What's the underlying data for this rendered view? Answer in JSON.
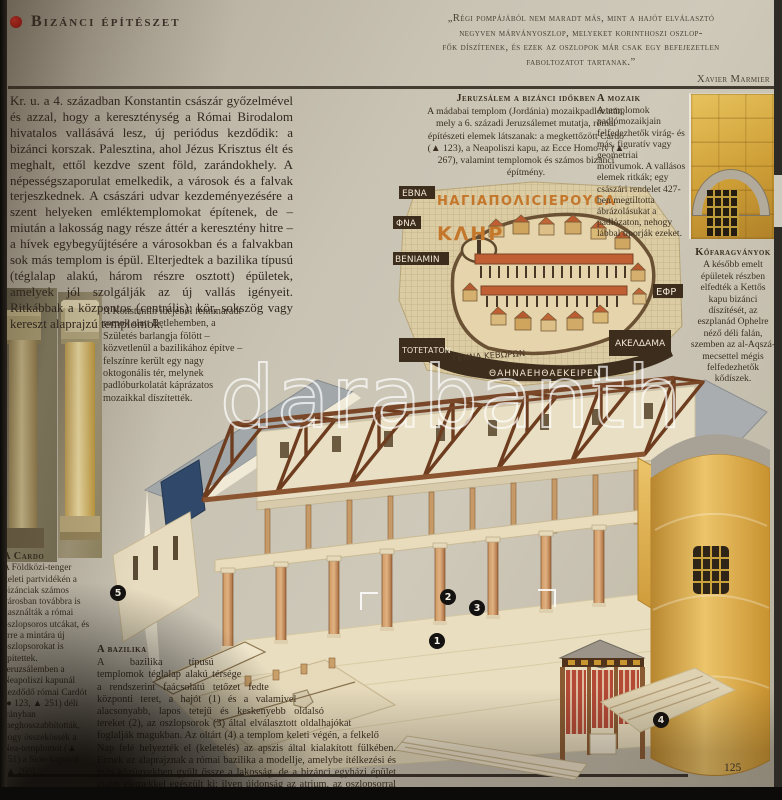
{
  "header": {
    "title": "Bizánci építészet"
  },
  "quote": {
    "l1": "„Régi pompájából nem maradt más, mint a hajót elválasztó",
    "l2": "negyven márványoszlop, melyeket korinthoszi oszlop-",
    "l3": "fők díszítenek, és ezek az oszlopok már csak egy befejezetlen",
    "l4": "faboltozatot tartanak.”",
    "attribution": "Xavier Marmier"
  },
  "intro": {
    "text": "Kr. u. a 4. században Konstantin császár győzelmével és azzal, hogy a kereszténység a Római Birodalom hivatalos vallásává lesz, új periódus kezdődik: a bizánci korszak. Palesztina, ahol Jézus Krisztus élt és meghalt, ettől kezdve szent föld, zarándokhely. A népességszaporulat emelkedik, a városok és a falvak terjeszkednek. A császári udvar kezdeményezésére a szent helyeken emléktemplomokat építenek, de – miután a lakosság nagy része áttér a keresztény hitre – a hívek egybegyűjtésére a városokban és a falvakban sok más templom is épül. Elterjedtek a bazilika típusú (téglalap alakú, három részre osztott) épületek, amelyek jól szolgálják az új vallás igényeit. Ritkábbak a központos (centrális): kör, sokszög vagy kereszt alaprajzú templomok."
  },
  "constantine": {
    "text": "A Konstantin idejéből fennmaradt romok alatt Betlehemben, a Születés barlangja fölött – közvetlenül a bazilikához építve – felszínre került egy nagy oktogonális tér, melynek padlóburkolatát káprázatos mozaikkal díszítették."
  },
  "jerusalem": {
    "heading": "Jeruzsálem a bizánci időkben",
    "text": "A mádabai templom (Jordánia) mozaikpadlózatán, mely a 6. századi Jeruzsálemet mutatja, római építészeti elemek látszanak: a megkettőzött Cardo (▲ 123), a Neapoliszi kapu, az Ecce Homo-ív (▲ 267), valamint templomok és számos bizánci építmény."
  },
  "mosaic": {
    "heading": "A mozaik",
    "text": "A templomok padlómozaikjain felfedezhetők virág- és más, figuratív vagy geometriai motívumok. A vallásos elemek ritkák; egy császári rendelet 427-ben megtiltotta ábrázolásukat a padlózaton, nehogy lábbal tiporják ezeket."
  },
  "stone": {
    "heading": "Kőfaragványok",
    "text": "A később emelt épületek részben elfedték a Kettős kapu bizánci díszítését, az eszplanád Ophelre néző déli falán, szemben az al-Aqszá-mecsettel mégis felfedezhetők kődíszek."
  },
  "cardo": {
    "heading": "A Cardo",
    "text": "A Földközi-tenger keleti partvidékén a bizánciak számos városban továbbra is használták a római oszlopsoros utcákat, és erre a mintára új oszlopsorokat is építettek. Jeruzsálemben a Neapoliszi kapunál kezdődő római Cardót (● 123, ▲ 251) déli irányban meghosszabbították, hogy összekössék a Nea-templomot (▲ 251) a Sion-kapuval (▲ 260)."
  },
  "basilica": {
    "heading": "A bazilika",
    "text": "A bazilika típusú templomok téglalap alakú térsége a rendszerint faácsolatú tetőzet fedte központi teret, a hajót (1) és a valamivel alacsonyabb, lapos tetejű és keskenyebb oldalsó tereket (2), az oszlopsorok (3) által elválasztott oldalhajókat foglalják magukban. Az oltárt (4) a templom keleti végén, a felkelő Nap felé helyezték el (keletelés) az apszis által kialakított fülkében. Ennek az alaprajznak a római bazilika a modellje, amelybe ítélkezési és más közügyekben gyűlt össze a lakosság, de a bizánci egyházi épület újabb elemekkel egészült ki: ilyen újdonság az atrium, az oszlopsorral övezett udvar és a narthex (5), a főhajó bejárata előtt széles folyosó."
  },
  "markers": [
    "1",
    "2",
    "3",
    "4",
    "5"
  ],
  "map_labels": {
    "holy_city": "ΗΑΓΙΑΠΟΛΙCΙΕΡΟΥCΑ",
    "kler": "ΚΛΗΡ",
    "ebna": "ΕΒΝΑ",
    "fna": "ΦΝΑ",
    "beniamin": "ΒΕΝΙΑΜΙΝ",
    "efr": "ΕΦΡ",
    "totet": "ΤΟΤΕΤΑΤΟΝ",
    "gennath": "ΓΕΝΝΑ ΚΕΒΩΡΩΝ",
    "akeldama": "ΑΚΕΛΔΑΜΑ",
    "bottom_band": "ΘΑΗΝΑΕΗΘΑΕΚΕΙΡΕΝ"
  },
  "watermark": {
    "text": "darabanth"
  },
  "footer": {
    "page_number": "125"
  },
  "colors": {
    "accent_red": "#c41410",
    "paper": "#c9c3b4",
    "gold_wall": "#dcaa4e",
    "terracotta_roof": "#c05f33",
    "roof_gray": "#a2a8aa",
    "timber_brown": "#6e3d1f",
    "ink": "#322820"
  }
}
